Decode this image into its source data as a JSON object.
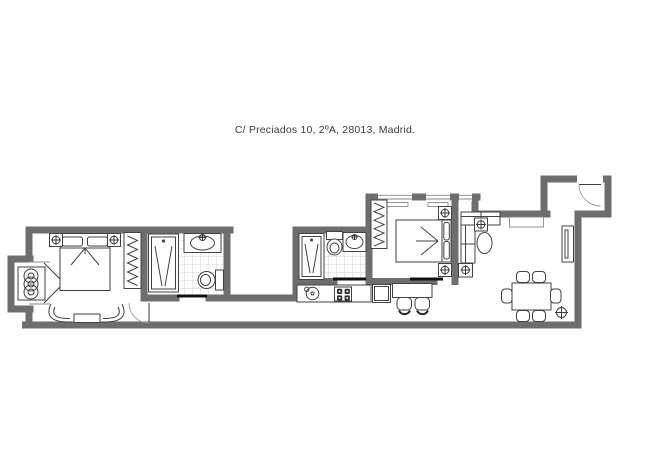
{
  "title": {
    "text": "C/ Preciados 10, 2ºA, 28013, Madrid."
  },
  "plan": {
    "colors": {
      "wall": "#6e6e6e",
      "furniture_line": "#424242",
      "tile_line": "#c9c9c9",
      "sliding_door": "#111111",
      "background": "#ffffff"
    },
    "rooms": [
      {
        "name": "bedroom-1",
        "furniture": [
          "double-bed",
          "nightstand-lamp",
          "nightstand-lamp",
          "wardrobe",
          "armchair",
          "armchair",
          "bench",
          "balcony-recess-radiator",
          "french-window",
          "swing-door"
        ]
      },
      {
        "name": "bathroom-1",
        "furniture": [
          "shower",
          "washbasin",
          "toilet",
          "tiled-floor",
          "sliding-door"
        ]
      },
      {
        "name": "light-well",
        "furniture": []
      },
      {
        "name": "bathroom-2",
        "furniture": [
          "shower",
          "toilet",
          "washbasin",
          "tiled-floor",
          "sliding-door"
        ]
      },
      {
        "name": "kitchen",
        "furniture": [
          "counter",
          "sink",
          "hob-4-burners",
          "fridge",
          "bar-counter",
          "stool",
          "stool"
        ]
      },
      {
        "name": "bedroom-2",
        "furniture": [
          "double-bed",
          "nightstand-lamp",
          "nightstand-lamp",
          "wardrobe",
          "window",
          "window",
          "sliding-door"
        ]
      },
      {
        "name": "living-dining",
        "furniture": [
          "sofa",
          "coffee-table",
          "wall-lamp",
          "floor-lamp",
          "console",
          "cabinet",
          "dining-table",
          "dining-chair-x6",
          "floor-lamp-dining"
        ]
      },
      {
        "name": "entry",
        "furniture": [
          "entrance-door"
        ]
      }
    ]
  }
}
